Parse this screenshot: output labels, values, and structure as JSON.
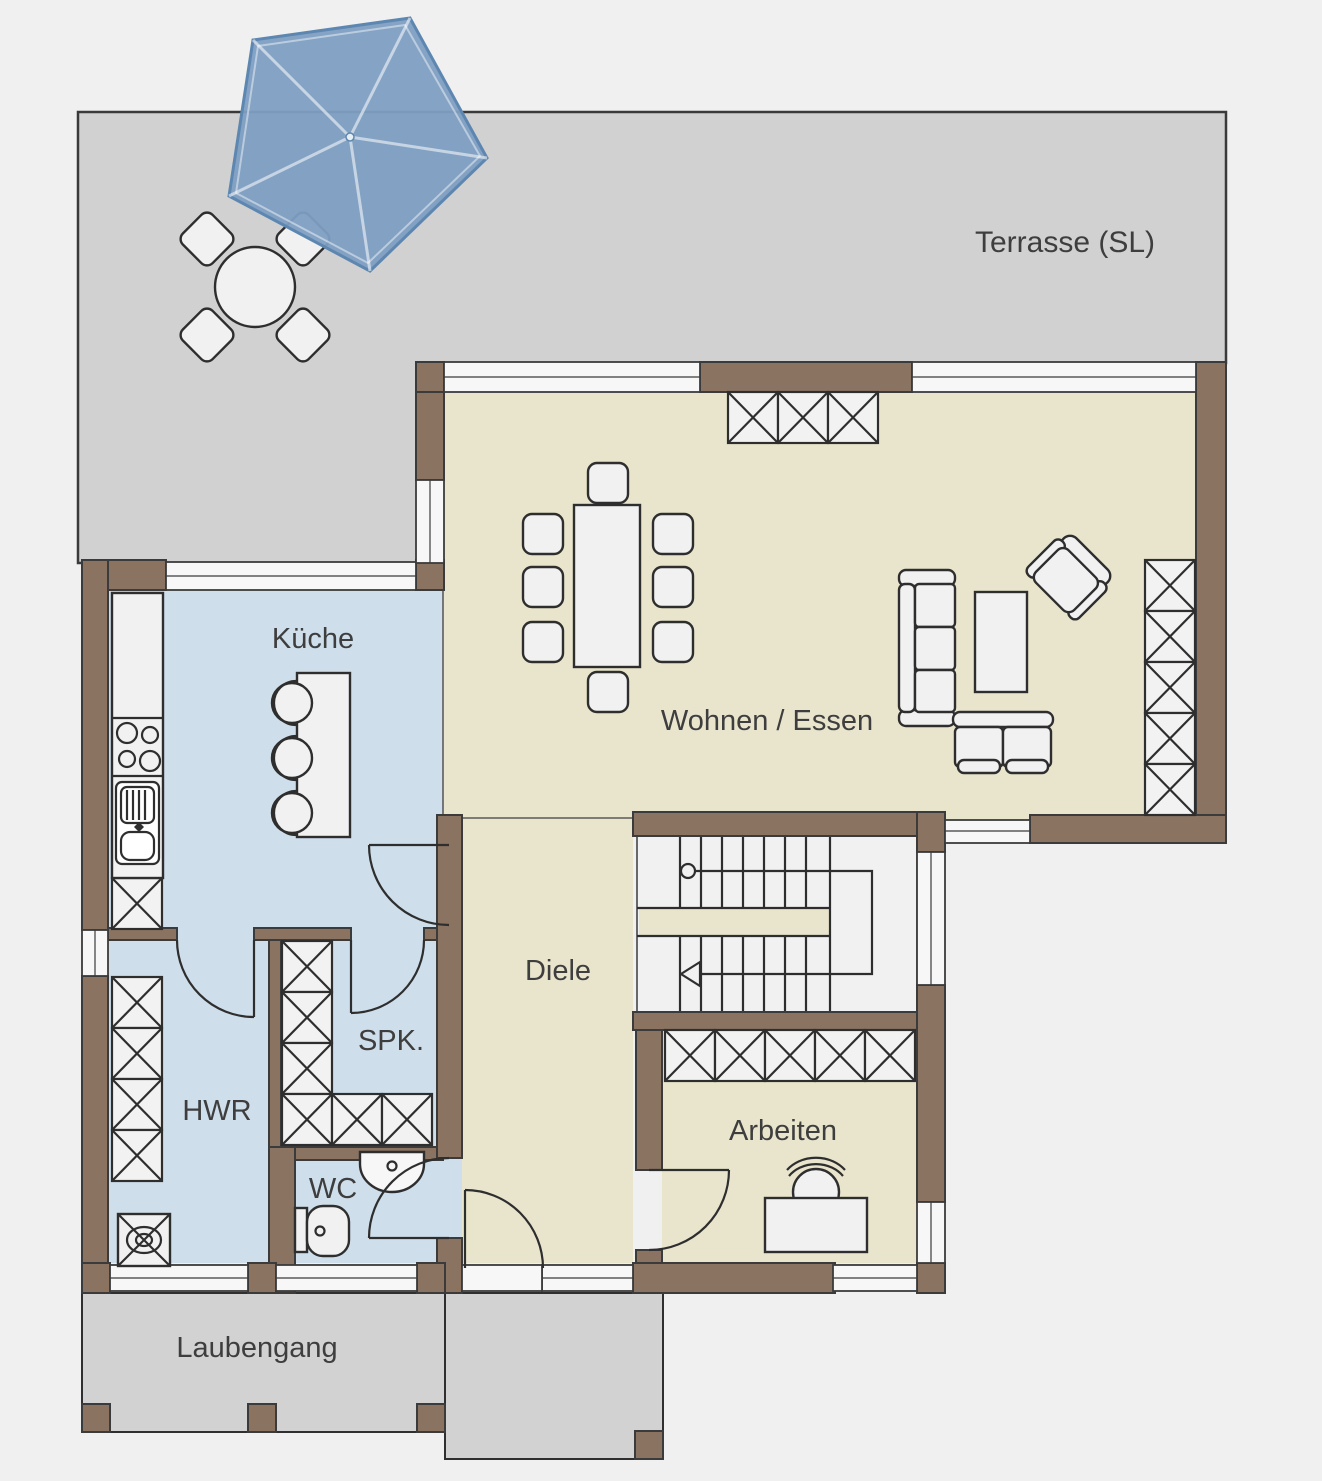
{
  "rooms": {
    "terrasse": {
      "label": "Terrasse (SL)"
    },
    "kueche": {
      "label": "Küche"
    },
    "wohnen": {
      "label": "Wohnen / Essen"
    },
    "diele": {
      "label": "Diele"
    },
    "spk": {
      "label": "SPK."
    },
    "hwr": {
      "label": "HWR"
    },
    "wc": {
      "label": "WC"
    },
    "arbeiten": {
      "label": "Arbeiten"
    },
    "laubengang": {
      "label": "Laubengang"
    }
  },
  "palette": {
    "wall_brown": "#8a7361",
    "floor_living": "#e9e5cd",
    "floor_wet": "#cfdeeb",
    "terrace_gray": "#d1d1d1",
    "umbrella_blue": "#7d9ec2",
    "line_dark": "#2e2e2e",
    "background": "#f0f0f0"
  }
}
